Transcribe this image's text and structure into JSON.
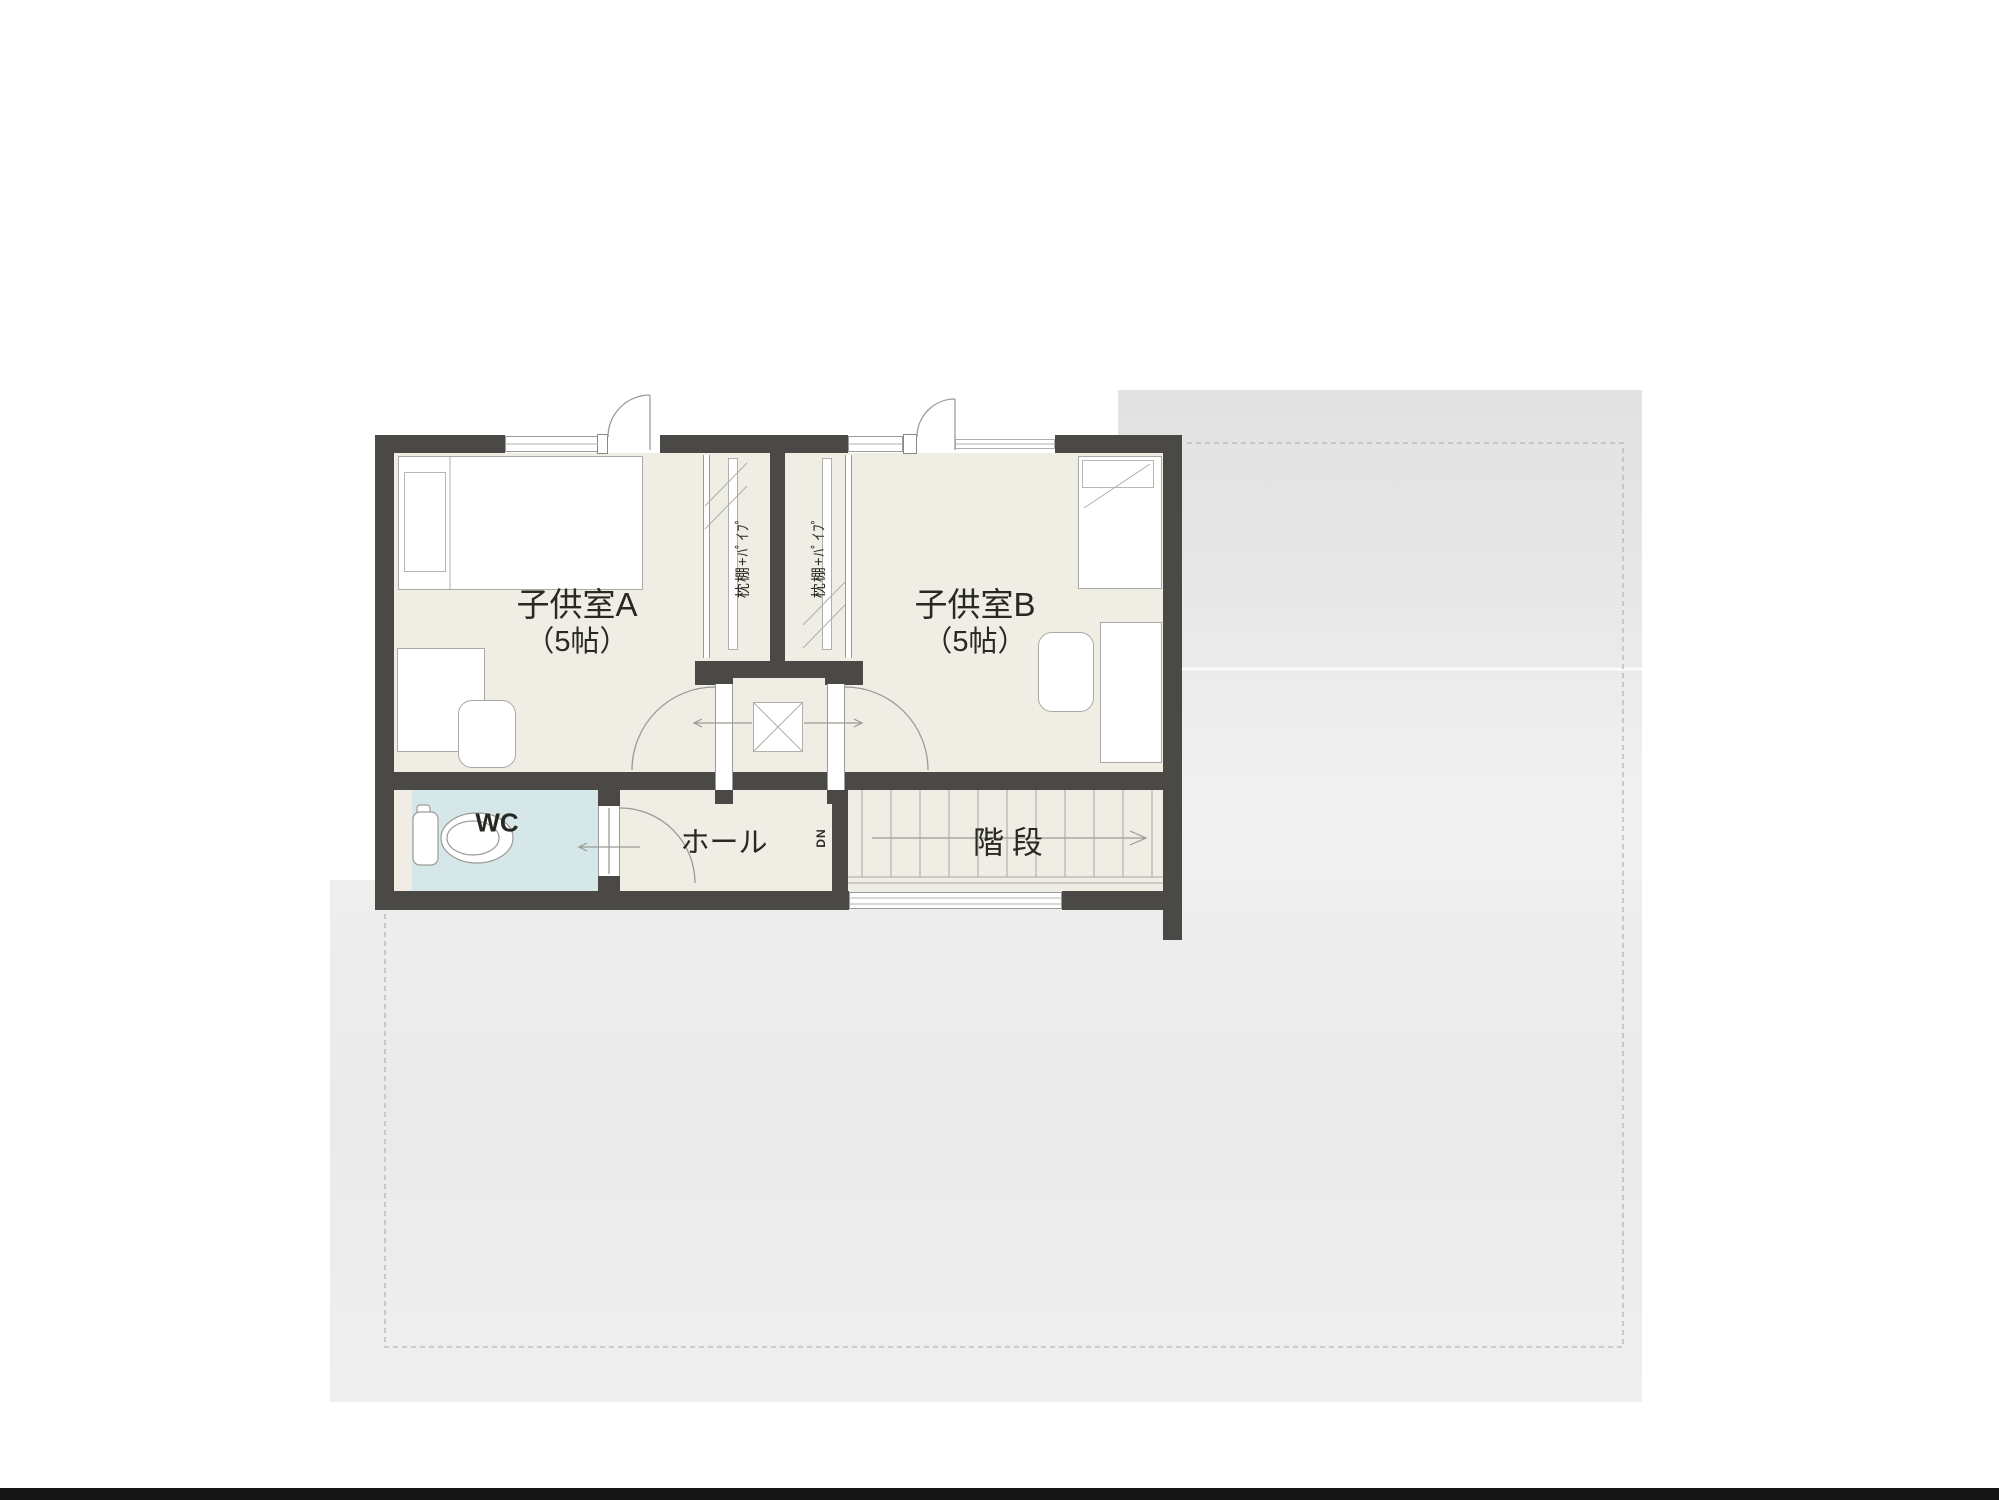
{
  "rooms": [
    {
      "id": "kids-room-a",
      "name": "子供室A",
      "size": "（5帖）"
    },
    {
      "id": "kids-room-b",
      "name": "子供室B",
      "size": "（5帖）"
    },
    {
      "id": "toilet",
      "name": "WC"
    },
    {
      "id": "hall",
      "name": "ホール"
    },
    {
      "id": "staircase",
      "name": "階段"
    }
  ],
  "closets": [
    {
      "label": "枕棚+ﾊﾟｲﾌﾟ"
    },
    {
      "label": "枕棚+ﾊﾟｲﾌﾟ"
    }
  ],
  "stair_info": {
    "direction_label": "DN"
  },
  "colors": {
    "wall": "#4a4945",
    "floor": "#efede4",
    "wc_floor": "#d6e7e9",
    "roof": "#e4e4e4",
    "line": "#9a9a96",
    "text": "#282824"
  }
}
